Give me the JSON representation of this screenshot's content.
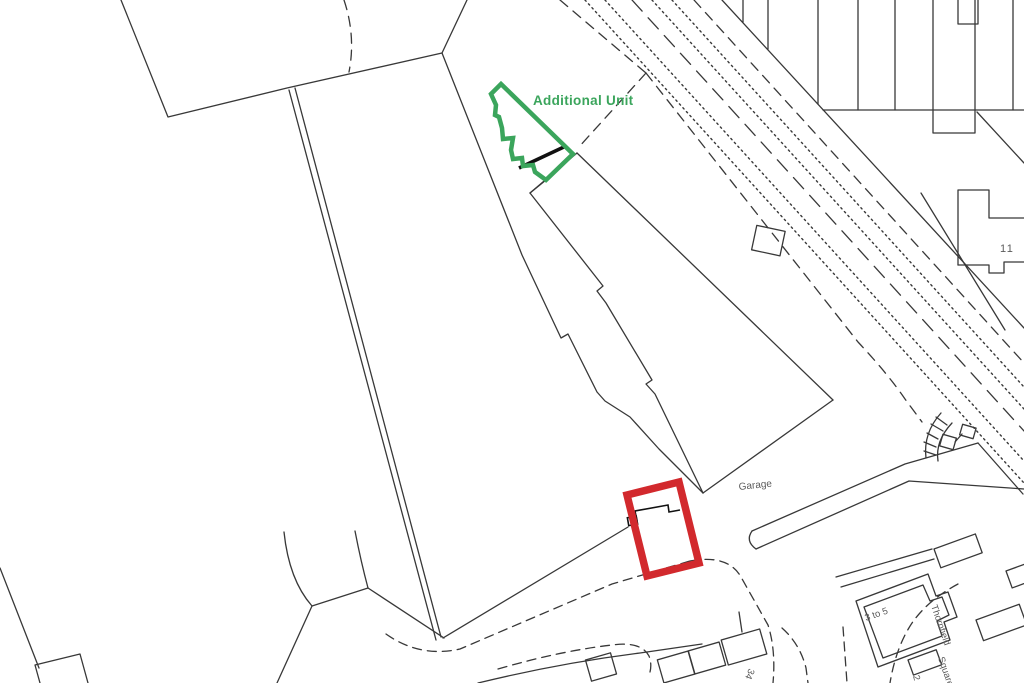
{
  "map": {
    "type": "site-location-plan",
    "labels": {
      "additional_unit": "Additional Unit",
      "garage": "Garage",
      "building_11": "11",
      "three_to_five": "3 to 5",
      "thornfield_line1": "Thornfield",
      "thornfield_line2": "Square",
      "house_2": "2",
      "house_34": "34"
    },
    "colors": {
      "background": "#ffffff",
      "linework": "#383838",
      "label_text": "#5a5a5a",
      "highlight_green": "#3BA55C",
      "highlight_red": "#D2292D",
      "building_detail": "#111111"
    }
  }
}
